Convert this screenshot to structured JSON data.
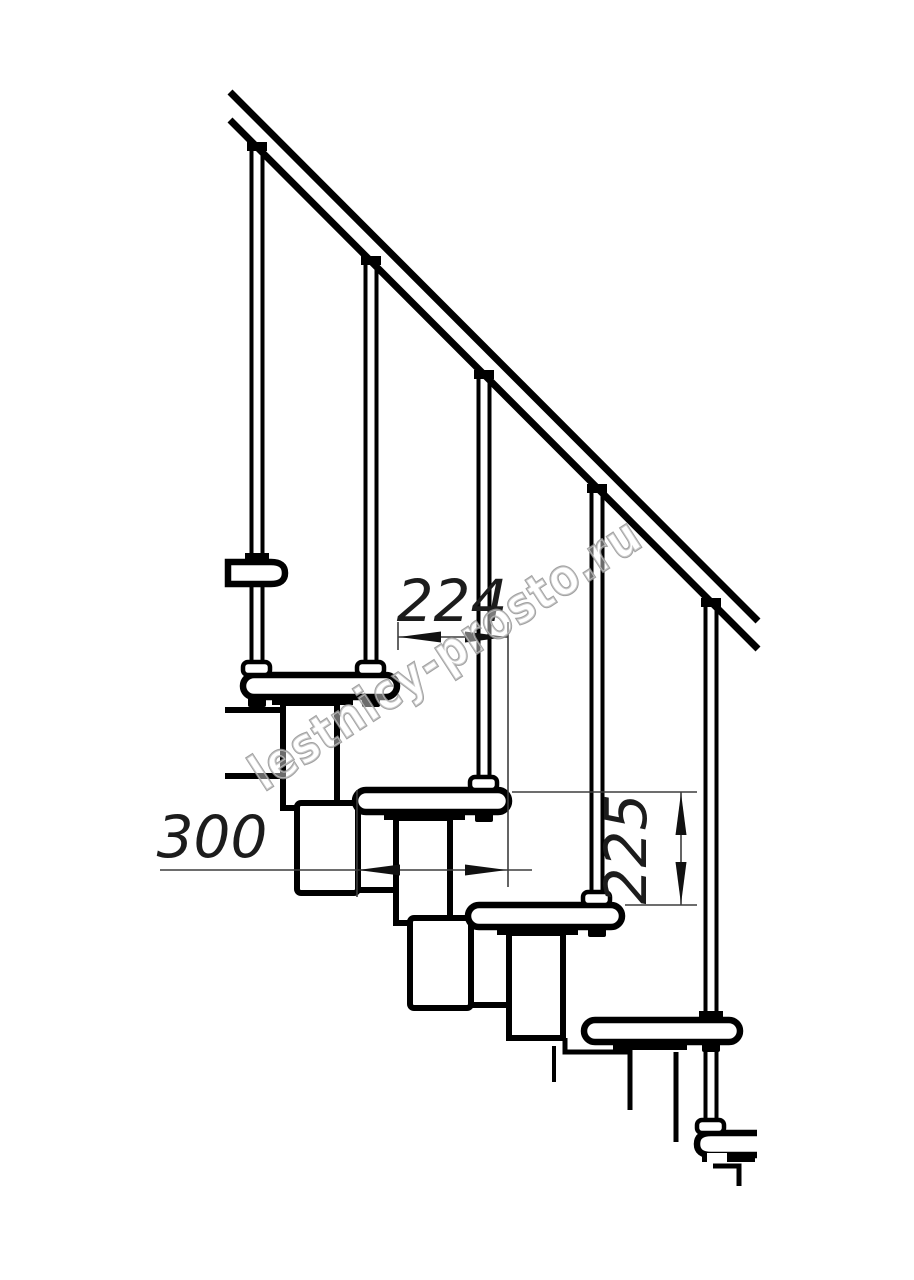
{
  "drawing": {
    "dimensions": {
      "run": "224",
      "depth": "300",
      "rise": "225"
    },
    "watermark": {
      "text": "lestnicy-prosto.ru"
    },
    "colors": {
      "line": "#000000",
      "dimension": "#3d3d3d",
      "watermark": "#909090",
      "background": "#ffffff"
    }
  }
}
